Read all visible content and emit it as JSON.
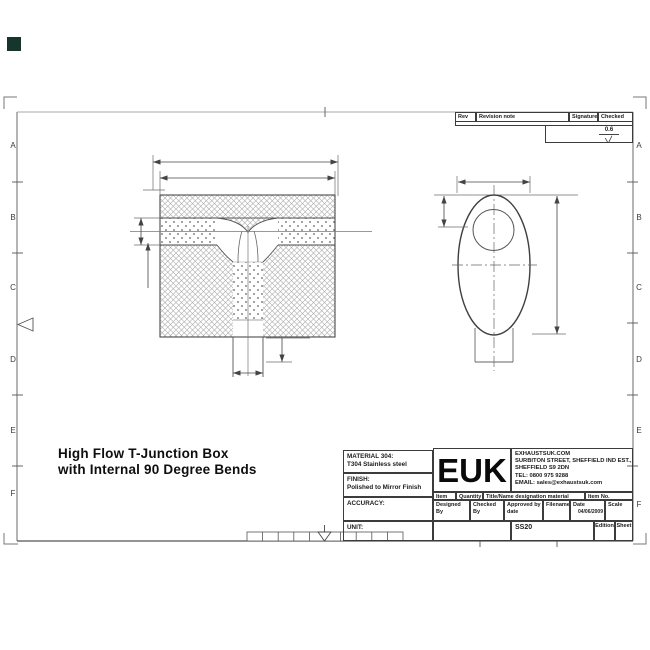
{
  "frame": {
    "letters_left": [
      "A",
      "B",
      "C",
      "D",
      "E",
      "F"
    ],
    "letters_right": [
      "A",
      "B",
      "C",
      "D",
      "E",
      "F"
    ]
  },
  "drawing_title": {
    "line1": "High Flow T-Junction Box",
    "line2": "with Internal 90 Degree Bends"
  },
  "revision_table": {
    "rev_no": "Rev No",
    "revision_note": "Revision note",
    "signature": "Signature",
    "checked": "Checked",
    "surface_finish": "0.6"
  },
  "title_block": {
    "material_label": "MATERIAL 304:",
    "material_value": "T304 Stainless steel",
    "finish_label": "FINISH:",
    "finish_value": "Polished to Mirror Finish",
    "accuracy_label": "ACCURACY:",
    "unit_label": "UNIT:",
    "logo": "EUK",
    "company_line1": "EXHAUSTSUK.COM",
    "company_line2": "SURBITON STREET, SHEFFIELD IND EST.,",
    "company_line3": "SHEFFIELD S9 2DN",
    "company_line4": "TEL: 0800 975 9288",
    "company_line5": "EMAIL: sales@exhaustsuk.com",
    "item_no_label": "Item No",
    "quantity_label": "Quantity",
    "title_name_label": "Title/Name designation material dimensions",
    "item_no2_label": "Item No.",
    "designed_by_label": "Designed By",
    "checked_by_label": "Checked By",
    "approved_label": "Approved by date",
    "filename_label": "Filename",
    "date_label": "Date",
    "date_value": "04/06/2009",
    "scale_label": "Scale",
    "drawing_number": "SS20",
    "edition_label": "Edition",
    "sheet_label": "Sheet"
  },
  "colors": {
    "line": "#4a4a4a",
    "corner_square": "#16352c"
  }
}
